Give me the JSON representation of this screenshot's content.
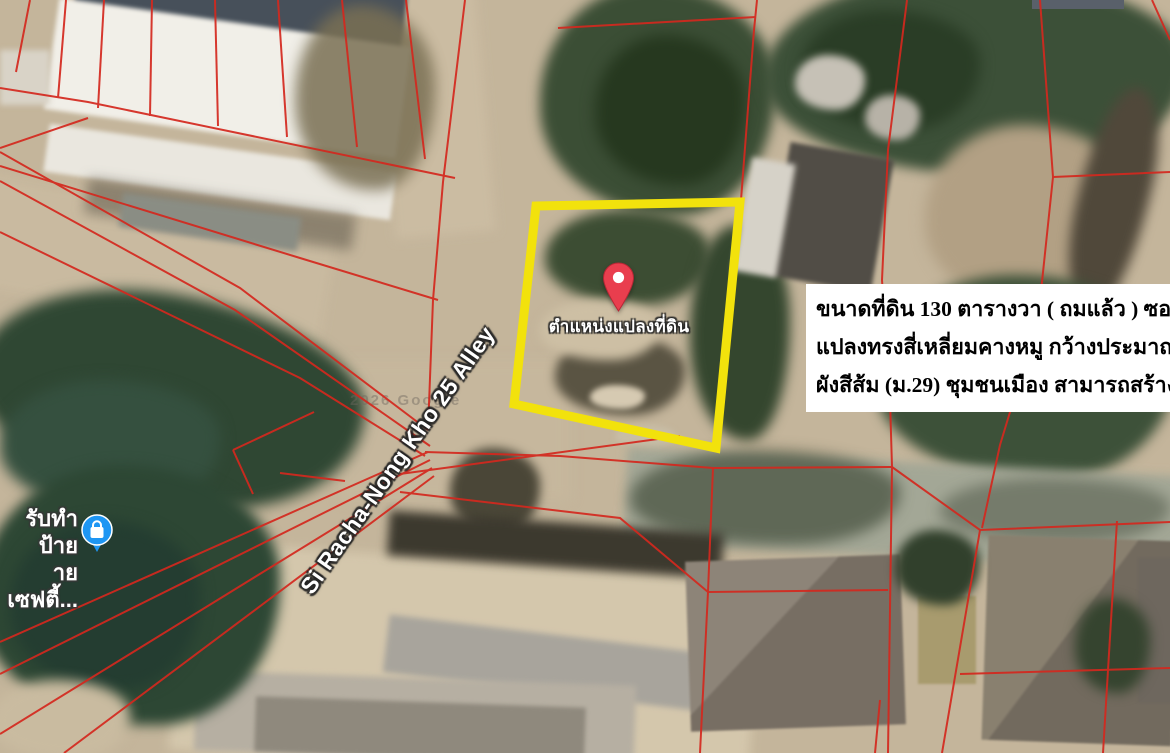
{
  "map": {
    "watermark": "2026 Google",
    "street_label": "Si Racha-Nong Kho 25 Alley",
    "pin_label": "ตำแหน่งแปลงที่ดิน",
    "pin_color": "#E93E4E",
    "highlight_color": "#F2E20C",
    "parcel_line_color": "#D4281E",
    "poi": {
      "icon": "shopping-bag-poi-icon",
      "color": "#1E96F3",
      "label_line1": "รับทำป้าย",
      "label_line2": "ายเซฟตี้..."
    },
    "info_box": {
      "background": "#FFFFFF",
      "text_color": "#000000",
      "lines": [
        "ขนาดที่ดิน 130 ตารางวา ( ถมแล้ว ) ซอย ศรีราชา - ",
        "แปลงทรงสี่เหลี่ยมคางหมู กว้างประมาณ 20.5 เมตร ",
        "ผังสีส้ม (ม.29) ชุมชนเมือง สามารถสร้างได้ 200 ตาร"
      ]
    }
  }
}
